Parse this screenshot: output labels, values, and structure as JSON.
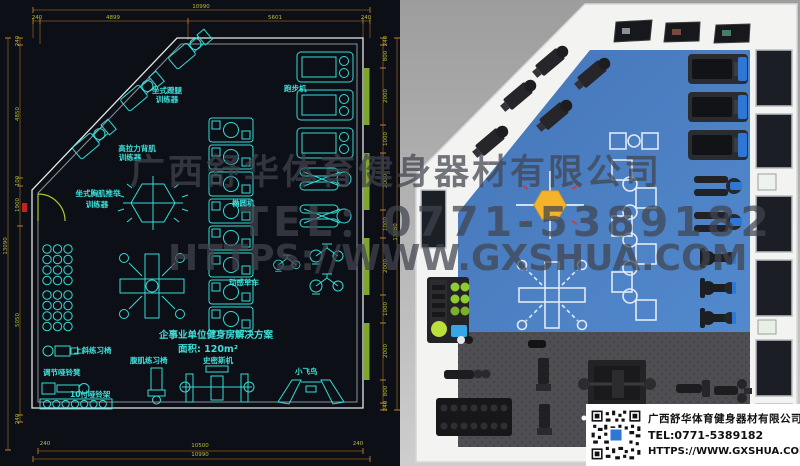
{
  "company": {
    "name": "广西舒华体育健身器材有限公司",
    "tel": "TEL:0771-5389182",
    "url": "HTTPS://WWW.GXSHUA.COM"
  },
  "watermark": {
    "line1": "广西舒华体育健身器材有限公司",
    "line2": "TEL：0771-5389182",
    "line3": "HTTPS://WWW.GXSHUA.COM"
  },
  "plan": {
    "title": [
      "企事业单位健身房解决方案",
      "面积: 120m²"
    ],
    "labels": {
      "leg_press": [
        "坐式蹬腿",
        "训练器"
      ],
      "lat_pull": [
        "高拉力背肌",
        "训练器"
      ],
      "chest_press": [
        "坐式胸肌推举",
        "训练器"
      ],
      "treadmill": "跑步机",
      "elliptical": "椭圆机",
      "spin_bike": "动感单车",
      "incline_bench": "上斜练习椅",
      "adj_dumbbell_bench": "调节哑铃凳",
      "dumbbell_rack": "10付哑铃架",
      "ab_bench": "腹肌练习椅",
      "smith_machine": "史密斯机",
      "cable_fly": "小飞鸟"
    },
    "dims": {
      "top": {
        "total": "10990",
        "segments": [
          "240",
          "4899",
          "5601",
          "240"
        ]
      },
      "bottom": {
        "inner": "10500",
        "outer": "10990",
        "left_tick": "240",
        "right_tick": "240"
      },
      "left": {
        "total": "13090",
        "segments": [
          "240",
          "4850",
          "100",
          "1900",
          "5050",
          "240"
        ]
      },
      "right": {
        "total": "13080",
        "segments": [
          "240",
          "800",
          "2000",
          "1000",
          "2000",
          "1000",
          "2000",
          "1000",
          "2000",
          "800",
          "240"
        ]
      }
    }
  },
  "colors": {
    "cad_equipment": "#35dcd6",
    "cad_dim_text": "#b9bd3a",
    "floor_blue": "#4b81c5",
    "light_yellow": "#f5b32c"
  }
}
